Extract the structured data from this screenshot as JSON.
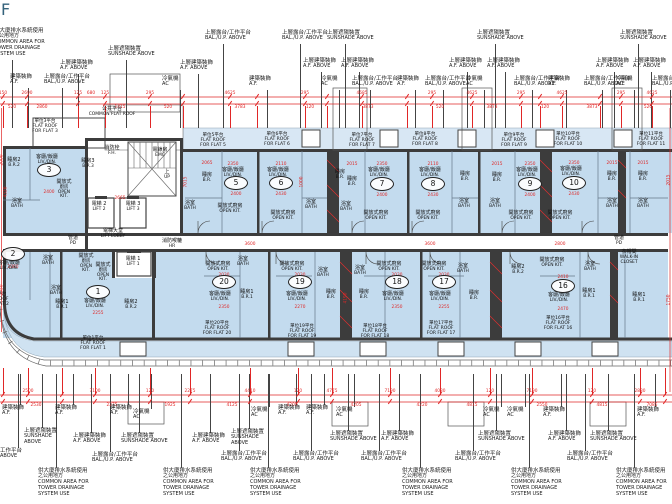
{
  "title": {
    "floor_label": "F"
  },
  "colors": {
    "flat_fill": "#c3dbee",
    "roof_strip": "#d8e7f4",
    "terrace": "#cfe2f1",
    "wall": "#3c3c3c",
    "dim_red": "#e02727",
    "title_color": "#35637c"
  },
  "lib": {
    "SUN": [
      "上層遮陽裝置",
      "SUNSHADE ABOVE"
    ],
    "SUN3": [
      "上層遮陽裝置",
      "SUNSHADE",
      "ABOVE"
    ],
    "AFA": [
      "上層建築裝飾",
      "A.F. ABOVE"
    ],
    "AF": [
      "建築裝飾",
      "A.F."
    ],
    "AC": [
      "冷氣機",
      "AC"
    ],
    "BAL": [
      "上層露台/工作平台",
      "BAL./U.P. ABOVE"
    ],
    "COM": [
      "供大廈排水系統使用",
      "之公用地方",
      "COMMON AREA FOR",
      "TOWER DRAINAGE",
      "SYSTEM USE"
    ],
    "CUT_BAL": [
      "工作平台",
      "ABOVE"
    ]
  },
  "annotations": {
    "top": [
      [
        -6,
        28,
        "COM"
      ],
      [
        60,
        60,
        "AFA"
      ],
      [
        108,
        46,
        "SUN"
      ],
      [
        180,
        60,
        "AFA"
      ],
      [
        10,
        74,
        "AF"
      ],
      [
        44,
        74,
        "BAL"
      ],
      [
        162,
        76,
        "AC"
      ],
      [
        205,
        30,
        "BAL"
      ],
      [
        282,
        30,
        "BAL"
      ],
      [
        327,
        30,
        "SUN"
      ],
      [
        303,
        58,
        "AFA"
      ],
      [
        341,
        58,
        "AFA"
      ],
      [
        249,
        76,
        "AF"
      ],
      [
        321,
        76,
        "AC"
      ],
      [
        352,
        76,
        "BAL"
      ],
      [
        397,
        76,
        "AF"
      ],
      [
        425,
        76,
        "BAL"
      ],
      [
        477,
        30,
        "SUN"
      ],
      [
        620,
        30,
        "SUN"
      ],
      [
        449,
        58,
        "AFA"
      ],
      [
        487,
        58,
        "AFA"
      ],
      [
        596,
        58,
        "AFA"
      ],
      [
        633,
        58,
        "AFA"
      ],
      [
        466,
        76,
        "AC"
      ],
      [
        514,
        76,
        "BAL"
      ],
      [
        548,
        76,
        "AF"
      ],
      [
        584,
        76,
        "BAL"
      ],
      [
        616,
        76,
        "AC"
      ],
      [
        652,
        76,
        "BAL"
      ]
    ],
    "bottom": [
      [
        0,
        448,
        "CUT_BAL"
      ],
      [
        2,
        405,
        "AF"
      ],
      [
        55,
        405,
        "AF"
      ],
      [
        24,
        428,
        "SUN3"
      ],
      [
        73,
        433,
        "AFA"
      ],
      [
        110,
        405,
        "AF"
      ],
      [
        133,
        409,
        "AC"
      ],
      [
        121,
        433,
        "SUN"
      ],
      [
        192,
        433,
        "AFA"
      ],
      [
        92,
        452,
        "BAL"
      ],
      [
        38,
        468,
        "COM"
      ],
      [
        163,
        468,
        "COM"
      ],
      [
        251,
        407,
        "AC"
      ],
      [
        278,
        405,
        "AF"
      ],
      [
        306,
        405,
        "AF"
      ],
      [
        231,
        429,
        "SUN3"
      ],
      [
        336,
        407,
        "AC"
      ],
      [
        330,
        431,
        "SUN"
      ],
      [
        381,
        431,
        "AFA"
      ],
      [
        221,
        451,
        "BAL"
      ],
      [
        293,
        451,
        "BAL"
      ],
      [
        361,
        451,
        "BAL"
      ],
      [
        250,
        468,
        "COM"
      ],
      [
        402,
        468,
        "COM"
      ],
      [
        483,
        407,
        "AC"
      ],
      [
        507,
        407,
        "AC"
      ],
      [
        543,
        407,
        "AF"
      ],
      [
        637,
        407,
        "AF"
      ],
      [
        478,
        431,
        "SUN"
      ],
      [
        590,
        431,
        "SUN"
      ],
      [
        548,
        431,
        "AFA"
      ],
      [
        455,
        451,
        "BAL"
      ],
      [
        567,
        451,
        "BAL"
      ],
      [
        511,
        468,
        "COM"
      ],
      [
        616,
        468,
        "COM"
      ]
    ]
  },
  "plan": {
    "rooms": [
      [
        47,
        155,
        [
          "客廳/飯廳",
          "LIV./DIN."
        ]
      ],
      [
        233,
        168,
        [
          "客廳/飯廳",
          "LIV./DIN."
        ]
      ],
      [
        278,
        168,
        [
          "客廳/飯廳",
          "LIV./DIN."
        ]
      ],
      [
        379,
        168,
        [
          "客廳/飯廳",
          "LIV./DIN."
        ]
      ],
      [
        430,
        168,
        [
          "客廳/飯廳",
          "LIV./DIN."
        ]
      ],
      [
        527,
        168,
        [
          "客廳/飯廳",
          "LIV./DIN."
        ]
      ],
      [
        571,
        167,
        [
          "客廳/飯廳",
          "LIV./DIN."
        ]
      ],
      [
        9,
        261,
        [
          "客廳/飯廳",
          "LIV./DIN."
        ]
      ],
      [
        95,
        299,
        [
          "客廳/飯廳",
          "LIV./DIN."
        ]
      ],
      [
        220,
        292,
        [
          "客廳/飯廳",
          "LIV./DIN."
        ]
      ],
      [
        297,
        292,
        [
          "客廳/飯廳",
          "LIV./DIN."
        ]
      ],
      [
        393,
        292,
        [
          "客廳/飯廳",
          "LIV./DIN."
        ]
      ],
      [
        440,
        292,
        [
          "客廳/飯廳",
          "LIV./DIN."
        ]
      ],
      [
        559,
        293,
        [
          "客廳/飯廳",
          "LIV./DIN."
        ]
      ],
      [
        14,
        158,
        [
          "睡房2",
          "B.R.2"
        ]
      ],
      [
        88,
        159,
        [
          "睡房3",
          "B.R.3"
        ]
      ],
      [
        207,
        173,
        [
          "睡房",
          "B.R."
        ]
      ],
      [
        340,
        170,
        [
          "睡房",
          "B.R."
        ]
      ],
      [
        352,
        177,
        [
          "睡房",
          "B.R."
        ]
      ],
      [
        465,
        172,
        [
          "睡房",
          "B.R."
        ]
      ],
      [
        497,
        173,
        [
          "睡房",
          "B.R."
        ]
      ],
      [
        612,
        172,
        [
          "睡房",
          "B.R."
        ]
      ],
      [
        643,
        172,
        [
          "睡房",
          "B.R."
        ]
      ],
      [
        62,
        300,
        [
          "睡房1",
          "B.R.1"
        ]
      ],
      [
        131,
        300,
        [
          "睡房2",
          "B.R.2"
        ]
      ],
      [
        247,
        290,
        [
          "睡房1",
          "B.R.1"
        ]
      ],
      [
        331,
        290,
        [
          "睡房",
          "B.R."
        ]
      ],
      [
        364,
        290,
        [
          "睡房",
          "B.R."
        ]
      ],
      [
        474,
        291,
        [
          "睡房",
          "B.R."
        ]
      ],
      [
        518,
        265,
        [
          "睡房2",
          "B.R.2"
        ]
      ],
      [
        589,
        289,
        [
          "睡房1",
          "B.R.1"
        ]
      ],
      [
        639,
        293,
        [
          "睡房1",
          "B.R.1"
        ]
      ],
      [
        17,
        199,
        [
          "浴室",
          "BATH"
        ]
      ],
      [
        190,
        201,
        [
          "浴室",
          "BATH"
        ]
      ],
      [
        311,
        200,
        [
          "浴室",
          "BATH"
        ]
      ],
      [
        346,
        202,
        [
          "浴室",
          "BATH"
        ]
      ],
      [
        464,
        199,
        [
          "浴室",
          "BATH"
        ]
      ],
      [
        495,
        199,
        [
          "浴室",
          "BATH"
        ]
      ],
      [
        612,
        199,
        [
          "浴室",
          "BATH"
        ]
      ],
      [
        643,
        199,
        [
          "浴室",
          "BATH"
        ]
      ],
      [
        48,
        256,
        [
          "浴室",
          "BATH"
        ]
      ],
      [
        56,
        286,
        [
          "浴室",
          "BATH"
        ]
      ],
      [
        243,
        257,
        [
          "浴室",
          "BATH"
        ]
      ],
      [
        323,
        268,
        [
          "浴室",
          "BATH"
        ]
      ],
      [
        360,
        266,
        [
          "浴室",
          "BATH"
        ]
      ],
      [
        463,
        264,
        [
          "浴室",
          "BATH"
        ]
      ],
      [
        590,
        262,
        [
          "浴室",
          "BATH"
        ]
      ],
      [
        230,
        204,
        [
          "開放式廚房",
          "OPEN KIT."
        ]
      ],
      [
        283,
        211,
        [
          "開放式廚房",
          "OPEN KIT."
        ]
      ],
      [
        376,
        211,
        [
          "開放式廚房",
          "OPEN KIT."
        ]
      ],
      [
        428,
        211,
        [
          "開放式廚房",
          "OPEN KIT."
        ]
      ],
      [
        521,
        211,
        [
          "開放式廚房",
          "OPEN KIT."
        ]
      ],
      [
        560,
        211,
        [
          "開放式廚房",
          "OPEN KIT."
        ]
      ],
      [
        218,
        262,
        [
          "開放式廚房",
          "OPEN KIT."
        ]
      ],
      [
        292,
        262,
        [
          "開放式廚房",
          "OPEN KIT."
        ]
      ],
      [
        389,
        262,
        [
          "開放式廚房",
          "OPEN KIT."
        ]
      ],
      [
        434,
        262,
        [
          "開放式廚房",
          "OPEN KIT."
        ]
      ],
      [
        552,
        258,
        [
          "開放式廚房",
          "OPEN KIT."
        ]
      ],
      [
        64,
        180,
        [
          "開放式",
          "廚房",
          "OPEN",
          "KIT."
        ]
      ],
      [
        86,
        254,
        [
          "開放式",
          "廚房",
          "OPEN",
          "KIT."
        ]
      ],
      [
        103,
        263,
        [
          "開放式",
          "廚房",
          "OPEN",
          "KIT."
        ]
      ],
      [
        112,
        146,
        [
          "消防栓",
          "F.H."
        ]
      ],
      [
        160,
        148,
        [
          "電錶房",
          "EMC"
        ]
      ],
      [
        99,
        202,
        [
          "電梯 2",
          "LIFT 2"
        ]
      ],
      [
        133,
        202,
        [
          "電梯 3",
          "LIFT 3"
        ]
      ],
      [
        133,
        257,
        [
          "電梯 1",
          "LIFT 1"
        ]
      ],
      [
        113,
        229,
        [
          "電梯大堂",
          "LIFT LOBBY"
        ]
      ],
      [
        73,
        236,
        [
          "管道",
          "PD"
        ]
      ],
      [
        619,
        236,
        [
          "管道",
          "PD"
        ]
      ],
      [
        172,
        239,
        [
          "消防喉轆",
          "HR"
        ]
      ],
      [
        167,
        170,
        [
          "上",
          "UP"
        ]
      ],
      [
        112,
        107,
        [
          "公共平台",
          "COMMON FLAT ROOF"
        ]
      ],
      [
        629,
        250,
        [
          "衣帽間",
          "WALK-IN",
          "CLOSET"
        ]
      ]
    ],
    "flat_roofs": [
      [
        45,
        119,
        [
          "單位3平台",
          "FLAT ROOF",
          "FOR FLAT 3"
        ]
      ],
      [
        213,
        133,
        [
          "單位5平台",
          "FLAT ROOF",
          "FOR FLAT 5"
        ]
      ],
      [
        277,
        132,
        [
          "單位6平台",
          "FLAT ROOF",
          "FOR FLAT 6"
        ]
      ],
      [
        362,
        133,
        [
          "單位7平台",
          "FLAT ROOF",
          "FOR FLAT 7"
        ]
      ],
      [
        425,
        132,
        [
          "單位8平台",
          "FLAT ROOF",
          "FOR FLAT 8"
        ]
      ],
      [
        514,
        133,
        [
          "單位9平台",
          "FLAT ROOF",
          "FOR FLAT 9"
        ]
      ],
      [
        568,
        132,
        [
          "單位10平台",
          "FLAT ROOF",
          "FOR FLAT 10"
        ]
      ],
      [
        651,
        132,
        [
          "單位11平台",
          "FLAT ROOF",
          "FOR FLAT 11"
        ]
      ],
      [
        93,
        336,
        [
          "單位1平台",
          "FLAT ROOF",
          "FOR FLAT 1"
        ]
      ],
      [
        -4,
        292,
        [
          "單位2平台",
          "FLAT ROOF",
          "FOR FLAT 2"
        ]
      ],
      [
        217,
        321,
        [
          "單位20平台",
          "FLAT ROOF",
          "FOR FLAT 20"
        ]
      ],
      [
        302,
        324,
        [
          "單位19平台",
          "FLAT ROOF",
          "FOR FLAT 19"
        ]
      ],
      [
        375,
        324,
        [
          "單位18平台",
          "FLAT ROOF",
          "FOR FLAT 18"
        ]
      ],
      [
        441,
        321,
        [
          "單位17平台",
          "FLAT ROOF",
          "FOR FLAT 17"
        ]
      ],
      [
        558,
        316,
        [
          "單位16平台",
          "FLAT ROOF",
          "FOR FLAT 16"
        ]
      ]
    ],
    "circles": [
      [
        49,
        170,
        "3"
      ],
      [
        236,
        183,
        "5"
      ],
      [
        281,
        183,
        "6"
      ],
      [
        382,
        184,
        "7"
      ],
      [
        433,
        184,
        "8"
      ],
      [
        530,
        184,
        "9"
      ],
      [
        574,
        183,
        "10"
      ],
      [
        13,
        254,
        "2"
      ],
      [
        98,
        292,
        "1"
      ],
      [
        224,
        282,
        "20"
      ],
      [
        300,
        282,
        "19"
      ],
      [
        397,
        282,
        "18"
      ],
      [
        444,
        282,
        "17"
      ],
      [
        563,
        286,
        "16"
      ]
    ]
  },
  "dims": {
    "h": [
      [
        207,
        161,
        "2065"
      ],
      [
        233,
        162,
        "2350"
      ],
      [
        281,
        162,
        "2110"
      ],
      [
        352,
        162,
        "2015"
      ],
      [
        382,
        162,
        "2350"
      ],
      [
        433,
        162,
        "2110"
      ],
      [
        497,
        162,
        "2015"
      ],
      [
        530,
        162,
        "2350"
      ],
      [
        574,
        161,
        "2350"
      ],
      [
        612,
        161,
        "2015"
      ],
      [
        643,
        161,
        "2015"
      ],
      [
        236,
        192,
        "2400"
      ],
      [
        281,
        192,
        "2430"
      ],
      [
        382,
        193,
        "2400"
      ],
      [
        433,
        193,
        "2430"
      ],
      [
        530,
        193,
        "2400"
      ],
      [
        574,
        192,
        "2430"
      ],
      [
        49,
        190,
        "2400"
      ],
      [
        120,
        196,
        "2665"
      ],
      [
        250,
        242,
        "3600"
      ],
      [
        430,
        242,
        "3600"
      ],
      [
        560,
        242,
        "2800"
      ],
      [
        224,
        273,
        "2030"
      ],
      [
        300,
        273,
        "2030"
      ],
      [
        397,
        273,
        "2030"
      ],
      [
        444,
        273,
        "2030"
      ],
      [
        563,
        275,
        "2410"
      ],
      [
        98,
        311,
        "2255"
      ],
      [
        224,
        305,
        "2350"
      ],
      [
        300,
        305,
        "2270"
      ],
      [
        397,
        305,
        "2350"
      ],
      [
        444,
        305,
        "2255"
      ],
      [
        563,
        307,
        "2470"
      ],
      [
        13,
        265,
        "2000"
      ]
    ],
    "v": [
      [
        186,
        182,
        "7015"
      ],
      [
        6,
        192,
        "4320"
      ],
      [
        302,
        182,
        "1000"
      ],
      [
        346,
        298,
        "4190"
      ],
      [
        2,
        160,
        "2000"
      ],
      [
        2,
        290,
        "3050"
      ],
      [
        669,
        180,
        "2015"
      ],
      [
        669,
        300,
        "1750"
      ]
    ]
  },
  "chain_top": {
    "y1": 97,
    "y2": 104,
    "wy": 106,
    "wh": 22,
    "above": [
      [
        3,
        "150"
      ],
      [
        27,
        "2690"
      ],
      [
        78,
        "125"
      ],
      [
        91,
        "680"
      ],
      [
        105,
        "125"
      ],
      [
        150,
        "295"
      ],
      [
        230,
        "4625"
      ],
      [
        305,
        "295"
      ],
      [
        362,
        "4685"
      ],
      [
        432,
        "295"
      ],
      [
        472,
        "4625"
      ],
      [
        521,
        "295"
      ],
      [
        562,
        "4625"
      ],
      [
        621,
        "295"
      ],
      [
        652,
        "4625"
      ]
    ],
    "below": [
      [
        12,
        "520"
      ],
      [
        42,
        "2860"
      ],
      [
        120,
        "1415"
      ],
      [
        168,
        "520"
      ],
      [
        240,
        "3783"
      ],
      [
        310,
        "120"
      ],
      [
        368,
        "3873"
      ],
      [
        440,
        "520"
      ],
      [
        492,
        "3873"
      ],
      [
        545,
        "120"
      ],
      [
        592,
        "3873"
      ],
      [
        648,
        "520"
      ]
    ],
    "witness": [
      3,
      27,
      78,
      105,
      150,
      183,
      230,
      257,
      305,
      327,
      362,
      407,
      432,
      472,
      521,
      540,
      562,
      600,
      621,
      652
    ]
  },
  "chain_bottom": {
    "y1": 395,
    "y2": 402,
    "wy": 368,
    "wh": 27,
    "above": [
      [
        28,
        "2500"
      ],
      [
        95,
        "7100"
      ],
      [
        150,
        "120"
      ],
      [
        190,
        "2275"
      ],
      [
        250,
        "4410"
      ],
      [
        298,
        "120"
      ],
      [
        332,
        "4775"
      ],
      [
        390,
        "7190"
      ],
      [
        440,
        "4080"
      ],
      [
        490,
        "120"
      ],
      [
        532,
        "7190"
      ],
      [
        592,
        "120"
      ],
      [
        640,
        "2880"
      ]
    ],
    "below": [
      [
        36,
        "2530"
      ],
      [
        112,
        "2275"
      ],
      [
        170,
        "1925"
      ],
      [
        232,
        "4125"
      ],
      [
        292,
        "4205"
      ],
      [
        356,
        "4205"
      ],
      [
        422,
        "4220"
      ],
      [
        472,
        "4815"
      ],
      [
        542,
        "2550"
      ],
      [
        602,
        "4815"
      ],
      [
        652,
        "7085"
      ]
    ],
    "witness": [
      3,
      28,
      62,
      95,
      150,
      190,
      250,
      298,
      332,
      390,
      440,
      490,
      532,
      592,
      640,
      665
    ]
  }
}
